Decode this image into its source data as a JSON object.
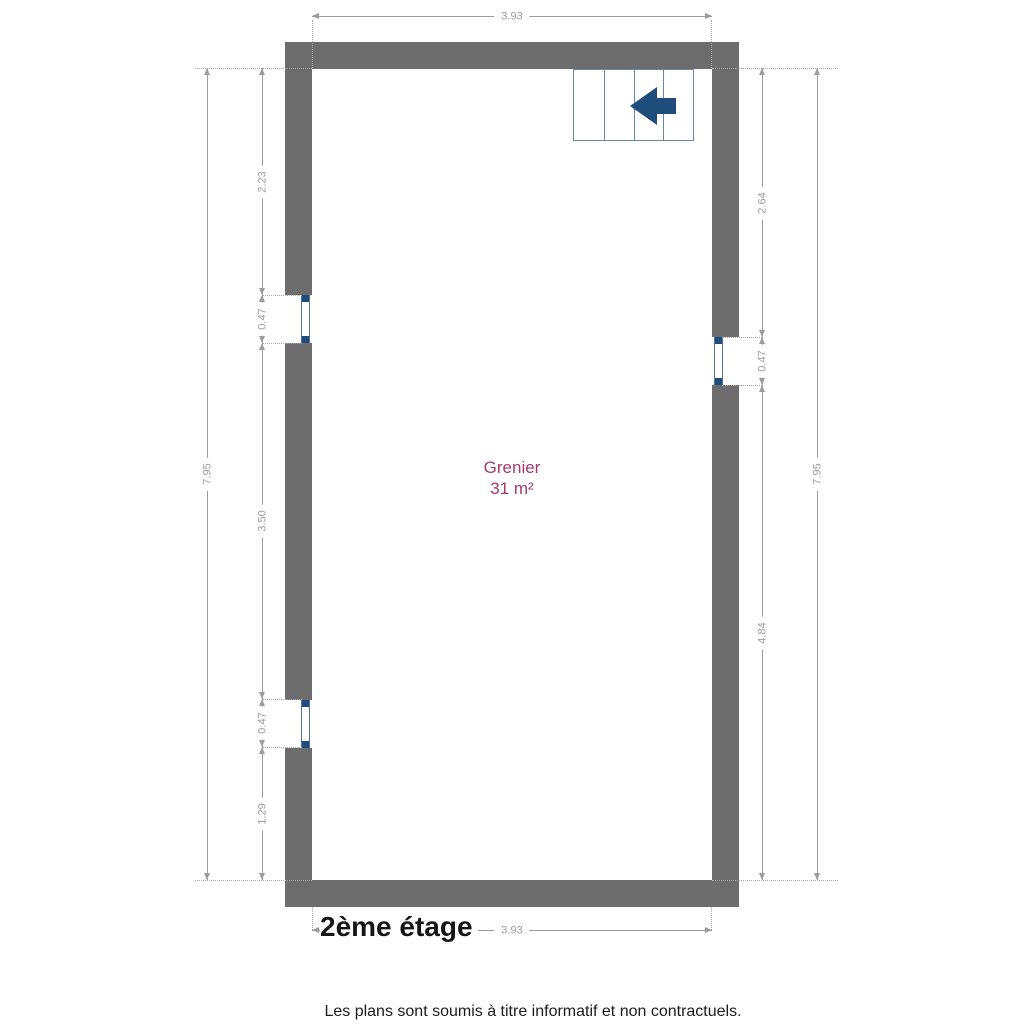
{
  "plan": {
    "floor_label": "2ème étage",
    "room": {
      "name": "Grenier",
      "area": "31 m²"
    },
    "disclaimer": "Les plans sont soumis à titre informatif et non contractuels.",
    "dimensions": {
      "top": "3.93",
      "bottom": "3.93",
      "left_outer": "7.95",
      "right_outer": "7.95",
      "left_inner": [
        "2.23",
        "0.47",
        "3.50",
        "0.47",
        "1.29"
      ],
      "right_inner": [
        "2.64",
        "0.47",
        "4.84"
      ]
    },
    "stairs": {
      "treads": 4,
      "arrow_direction": "left"
    },
    "windows": {
      "left_wall": 2,
      "right_wall": 1
    },
    "colors": {
      "wall": "#6d6d6d",
      "dimension": "#9c9c9c",
      "room_label": "#a5396f",
      "stair_outline": "#6c87a2",
      "stair_arrow": "#1e4d7b",
      "window_frame": "#4f7399",
      "window_cap": "#1e4d7b"
    }
  }
}
